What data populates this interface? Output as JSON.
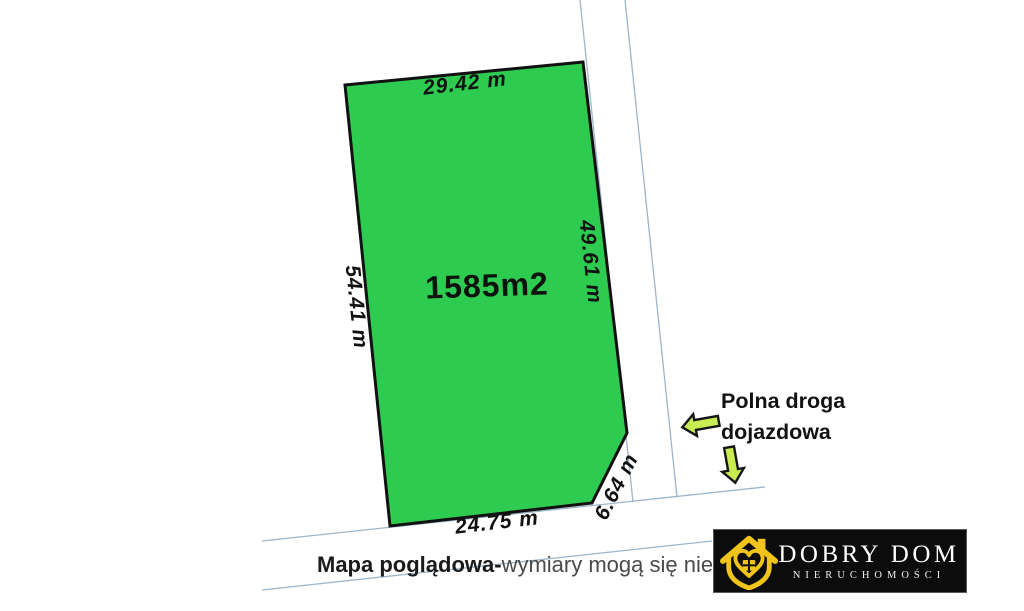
{
  "map": {
    "plot": {
      "area_label": "1585m2",
      "fill_color": "#2ecb51",
      "dimensions": {
        "top": "29.42 m",
        "left": "54.41 m",
        "right": "49.61 m",
        "bottom": "24.75 m",
        "corner": "6.64 m"
      }
    },
    "road_annotation": {
      "line1": "Polna droga",
      "line2": "dojazdowa",
      "arrow_color": "#c8ec52"
    },
    "boundary_line_color": "#9db6ca"
  },
  "caption": {
    "bold": "Mapa poglądowa-",
    "regular": "wymiary mogą się nieznaczn"
  },
  "logo": {
    "name": "DOBRY DOM",
    "subtitle": "NIERUCHOMOŚCI",
    "accent_color": "#f0c419",
    "background": "#0c0c0c"
  }
}
